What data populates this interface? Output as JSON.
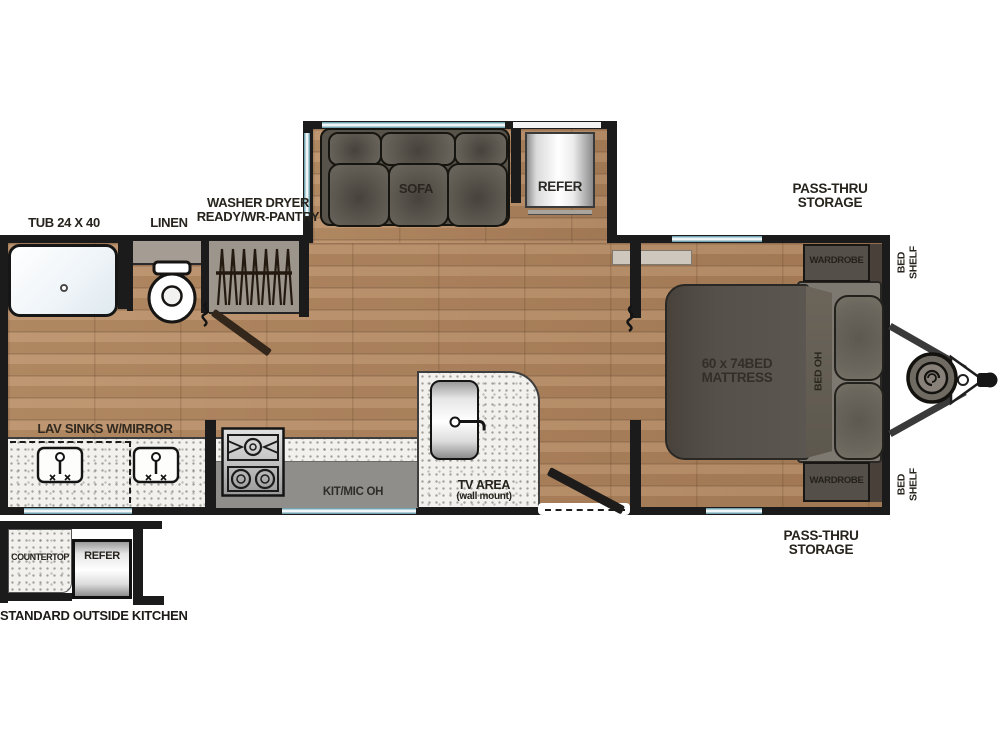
{
  "diagram": {
    "type": "rv-travel-trailer-floorplan",
    "labels": {
      "tub": "TUB 24 X 40",
      "linen": "LINEN",
      "washer_line1": "WASHER DRYER",
      "washer_line2": "READY/WR-PANTRY",
      "lav_sinks": "LAV SINKS W/MIRROR",
      "sofa": "SOFA",
      "refer": "REFER",
      "pass_thru_line1": "PASS-THRU",
      "pass_thru_line2": "STORAGE",
      "kit_mic_oh": "KIT/MIC OH",
      "tv_area_line1": "TV AREA",
      "tv_area_line2": "(wall mount)",
      "mattress_line1": "60 x 74BED",
      "mattress_line2": "MATTRESS",
      "bed_oh": "BED OH",
      "wardrobe": "WARDROBE",
      "bed_shelf_line1": "BED",
      "bed_shelf_line2": "SHELF",
      "countertop": "COUNTERTOP",
      "outside_kitchen_caption": "STANDARD OUTSIDE KITCHEN"
    },
    "fixtures": [
      "tub",
      "toilet",
      "hanging-closet",
      "sofa",
      "refrigerator",
      "cooktop",
      "lav-sinks",
      "kitchen-sink",
      "bed-mattress",
      "pillows",
      "wardrobes",
      "propane-tank",
      "a-frame-hitch",
      "entry-door",
      "interior-door"
    ],
    "colors": {
      "wall": "#1b1b1b",
      "wood_floor": "#b68a60",
      "window_glass": "#528e9f",
      "counter": "#f2f1ed",
      "overhead_cabinet": "#8f8e8a",
      "upholstery": "#5e5a52",
      "mattress": "#55514a",
      "bed_platform": "#7d7870",
      "wardrobe": "#544f48",
      "label_text": "#27231d"
    }
  }
}
